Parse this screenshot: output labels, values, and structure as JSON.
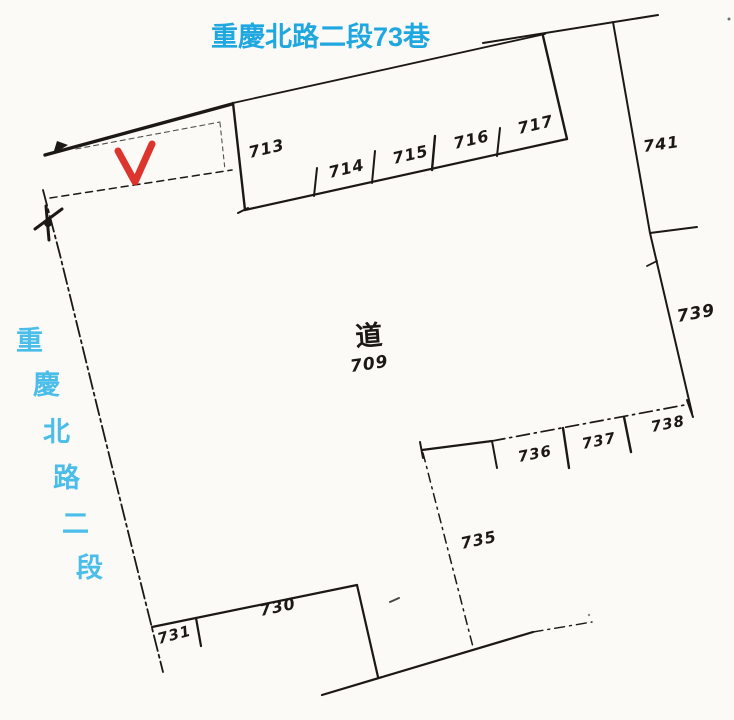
{
  "title": "重慶北路二段73巷",
  "road": {
    "name": "重慶北路二段",
    "chars": [
      "重",
      "慶",
      "北",
      "路",
      "二",
      "段"
    ]
  },
  "center_parcel": {
    "char": "道",
    "number": "709"
  },
  "parcels": [
    {
      "number": "713"
    },
    {
      "number": "714"
    },
    {
      "number": "715"
    },
    {
      "number": "716"
    },
    {
      "number": "717"
    },
    {
      "number": "741"
    },
    {
      "number": "739"
    },
    {
      "number": "738"
    },
    {
      "number": "737"
    },
    {
      "number": "736"
    },
    {
      "number": "735"
    },
    {
      "number": "730"
    },
    {
      "number": "731"
    }
  ],
  "colors": {
    "title_blue": "#1FA7E0",
    "road_blue": "#4BBDE9",
    "check_red": "#D8261D",
    "ink": "#1B1815",
    "paper": "#FBFAF7"
  }
}
